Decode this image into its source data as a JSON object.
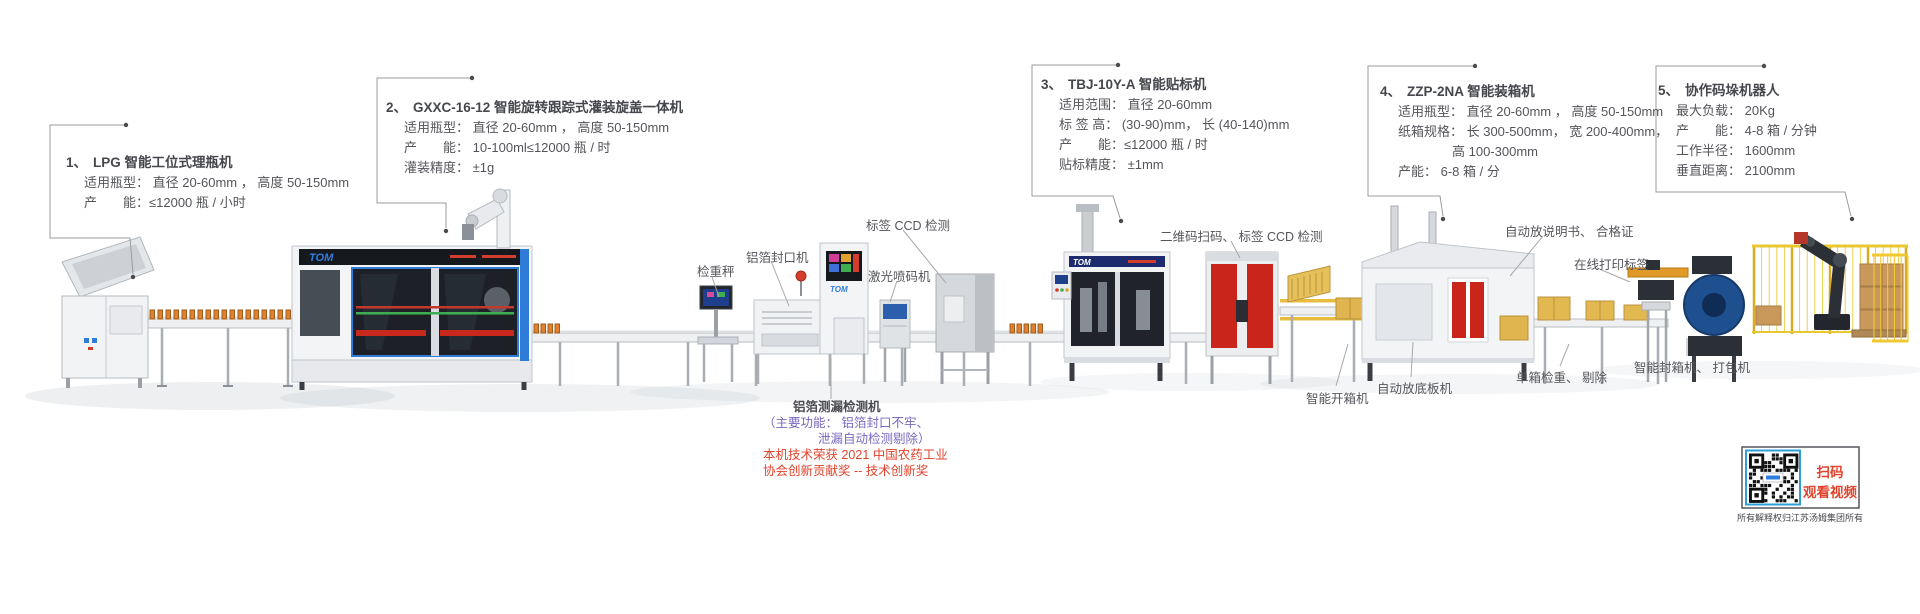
{
  "brand": {
    "logo": "TOM"
  },
  "spec_blocks": [
    {
      "number": "1、",
      "title": "LPG 智能工位式理瓶机",
      "lines": [
        "适用瓶型： 直径 20-60mm ， 高度 50-150mm",
        "产　　能：≤12000 瓶 / 小时"
      ]
    },
    {
      "number": "2、",
      "title": "GXXC-16-12 智能旋转跟踪式灌装旋盖一体机",
      "lines": [
        "适用瓶型： 直径 20-60mm ， 高度 50-150mm",
        "产　　能： 10-100ml≤12000 瓶 / 时",
        "灌装精度： ±1g"
      ]
    },
    {
      "number": "3、",
      "title": "TBJ-10Y-A 智能贴标机",
      "lines": [
        "适用范围： 直径 20-60mm",
        "标 签 高： (30-90)mm， 长 (40-140)mm",
        "产　　能：≤12000 瓶 / 时",
        "贴标精度： ±1mm"
      ]
    },
    {
      "number": "4、",
      "title": "ZZP-2NA 智能装箱机",
      "lines": [
        "适用瓶型： 直径 20-60mm ， 高度 50-150mm",
        "纸箱规格： 长 300-500mm， 宽 200-400mm，",
        "高 100-300mm",
        "产能： 6-8 箱 / 分"
      ]
    },
    {
      "number": "5、",
      "title": "协作码垛机器人",
      "lines": [
        "最大负载： 20Kg",
        "产　　能： 4-8 箱 / 分钟",
        "工作半径： 1600mm",
        "垂直距离： 2100mm"
      ]
    }
  ],
  "machine_labels": [
    {
      "text": "检重秤"
    },
    {
      "text": "铝箔封口机"
    },
    {
      "text": "标签 CCD 检测"
    },
    {
      "text": "激光喷码机"
    },
    {
      "text": "二维码扫码、 标签 CCD 检测"
    },
    {
      "text": "自动放说明书、 合格证"
    },
    {
      "text": "在线打印标签"
    },
    {
      "text": "智能开箱机"
    },
    {
      "text": "自动放底板机"
    },
    {
      "text": "单箱检重、 剔除"
    },
    {
      "text": "智能封箱机、 打包机"
    }
  ],
  "leak_detector_note": {
    "title": "铝箔测漏检测机",
    "purple_line1": "（主要功能： 铝箔封口不牢、",
    "purple_line2": "泄漏自动检测剔除）",
    "red_line1": "本机技术荣获 2021 中国农药工业",
    "red_line2": "协会创新贡献奖 -- 技术创新奖"
  },
  "qr_panel": {
    "line1": "扫码",
    "line2": "观看视频",
    "caption": "所有解释权归江苏汤姆集团所有"
  },
  "colors": {
    "accent_blue": "#2e7bd8",
    "machine_red": "#c9251b",
    "carton_yellow": "#e0b44e",
    "fence_yellow": "#eac832",
    "bottle_orange": "#e2802f",
    "note_purple": "#7b68c0",
    "note_red": "#e0432c",
    "text_gray": "#54555a"
  }
}
